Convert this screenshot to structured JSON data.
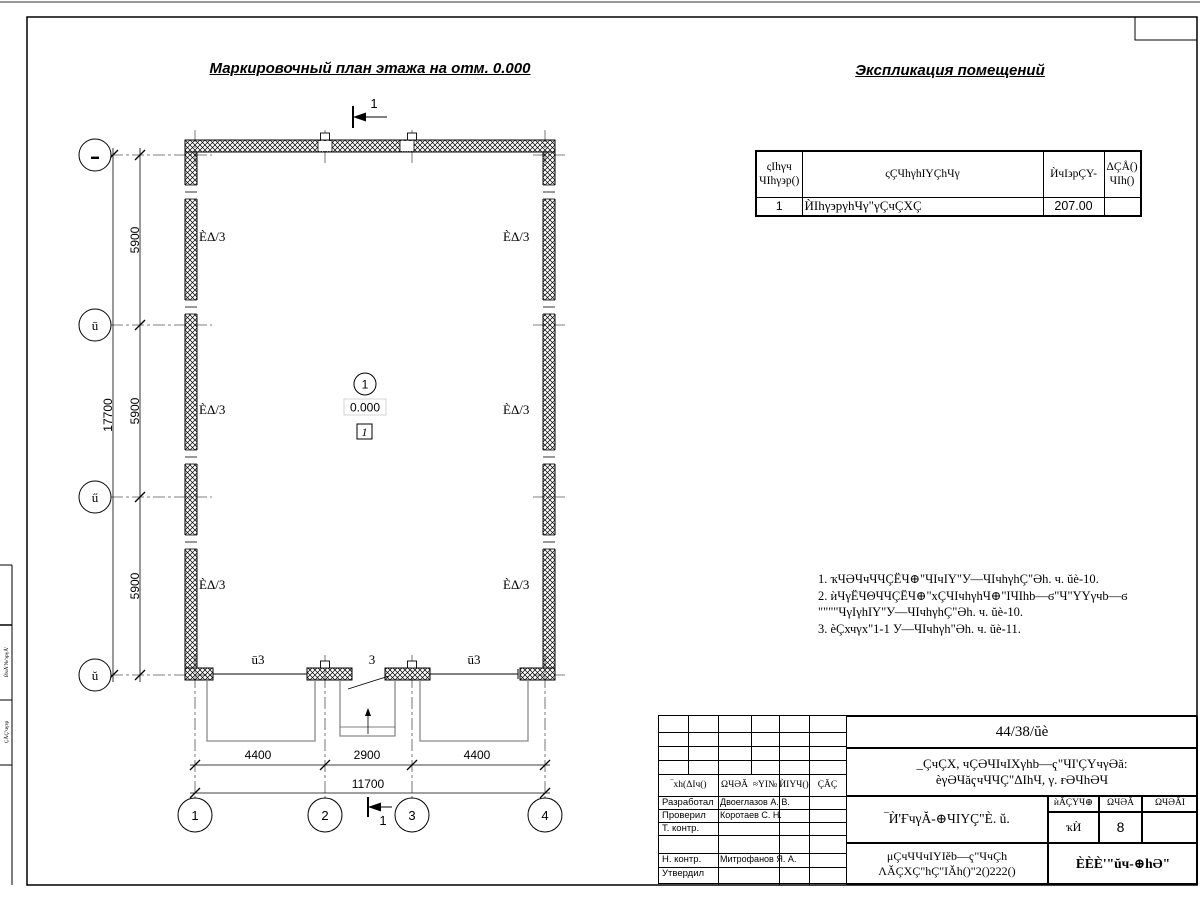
{
  "sheet": {
    "title_plan": "Маркировочный план этажа на отм. 0.000",
    "title_explication": "Экспликация помещений"
  },
  "explication": {
    "col_no_1": "ςIhγч",
    "col_no_2": "ЧIhγ϶p()",
    "col_name": "ςÇЧhγhIYÇhЧγ",
    "col_area": "ЍчI϶pÇY-",
    "col_note_1": "ΔÇÅ()",
    "col_note_2": "ЧIh()",
    "row_no": "1",
    "row_name": "ЍIhγ϶pγhЧγ\"γÇчÇXÇ",
    "row_area": "207.00",
    "row_note": ""
  },
  "notes": {
    "line1": "1. ҡЧӘЧчЧЧÇЁЧ⊕\"ЧIчIY\"У—ЧIчhγhÇ\"Әh. ч. ŭè-10.",
    "line2": "2. ѝЧγЁЧΘЧЧÇЁЧ⊕\"хÇЧIчhγhЧ⊕\"IЧIhb—ϭ\"Ч\"YYγчb—ϭ",
    "line3": "\"\"\"\"ЧγIγhIY\"У—ЧIчhγhÇ\"Әh. ч. ŭè-10.",
    "line4": "3. ѐÇхчγх\"1-1 У—ЧIчhγh\"Әh. ч. ŭè-11."
  },
  "plan": {
    "axis_left": [
      "▬",
      "ū",
      "ű",
      "ŭ"
    ],
    "axis_bottom": [
      "1",
      "2",
      "3",
      "4"
    ],
    "dim_v": [
      "5900",
      "5900",
      "5900"
    ],
    "dim_v_total": "17700",
    "dim_h": [
      "4400",
      "2900",
      "4400"
    ],
    "dim_h_total": "11700",
    "rooms": [
      "ÈΔ/3",
      "ÈΔ/3",
      "ÈΔ/3",
      "ÈΔ/3",
      "ÈΔ/3",
      "ÈΔ/3"
    ],
    "door_marks": [
      "ū3",
      "3",
      "ū3"
    ],
    "level": "0.000",
    "room_no": "1",
    "room_box": "1",
    "section_top": "1",
    "section_bottom": "1"
  },
  "titleblock": {
    "doc_no": "44/38/ŭè",
    "project_1": "_ÇчÇX, чÇӘЧIчIXγhb—ҁ\"ЧI'ÇYчγӘă:",
    "project_2": "ѐγӘЧăҁчЧЧÇ\"ΔIhЧ, γ. ғӘЧhӘЧ",
    "drawing_title": "‾Ѝ'ҒчγĂ-⊕ЧIYÇ\"È. ŭ.",
    "org_1": "μÇчЧЧчIYIĕb—ҁ\"ЧчÇh",
    "org_2": "ΛĂÇXÇ\"hÇ\"IĂh()\"2()222()",
    "company": "ÈÈÈ'\"ŭч-⊕hӘ\"",
    "head_cols": [
      "‾хh(ΔIч()",
      "ΩЧӘĂ",
      "≈YI№",
      "ЍIYЧ()",
      "ÇĂÇ"
    ],
    "stage_head": [
      "ѝĂÇYЧ⊕",
      "ΩЧӘĂ",
      "ΩЧӘĂI"
    ],
    "stage_vals": [
      "ҡЍ",
      "8",
      ""
    ],
    "roles": [
      "Разработал",
      "Проверил",
      "Т. контр.",
      "",
      "Н. контр.",
      "Утвердил"
    ],
    "names": [
      "Двоеглазов А. В.",
      "Коротаев С. Н.",
      "",
      "",
      "Митрофанов Я. А.",
      ""
    ]
  },
  "side": {
    "strip_top": "ЍчĂ'№'϶pγĂ'",
    "strip_bottom": "ÇĂÇ'чγ϶p"
  }
}
